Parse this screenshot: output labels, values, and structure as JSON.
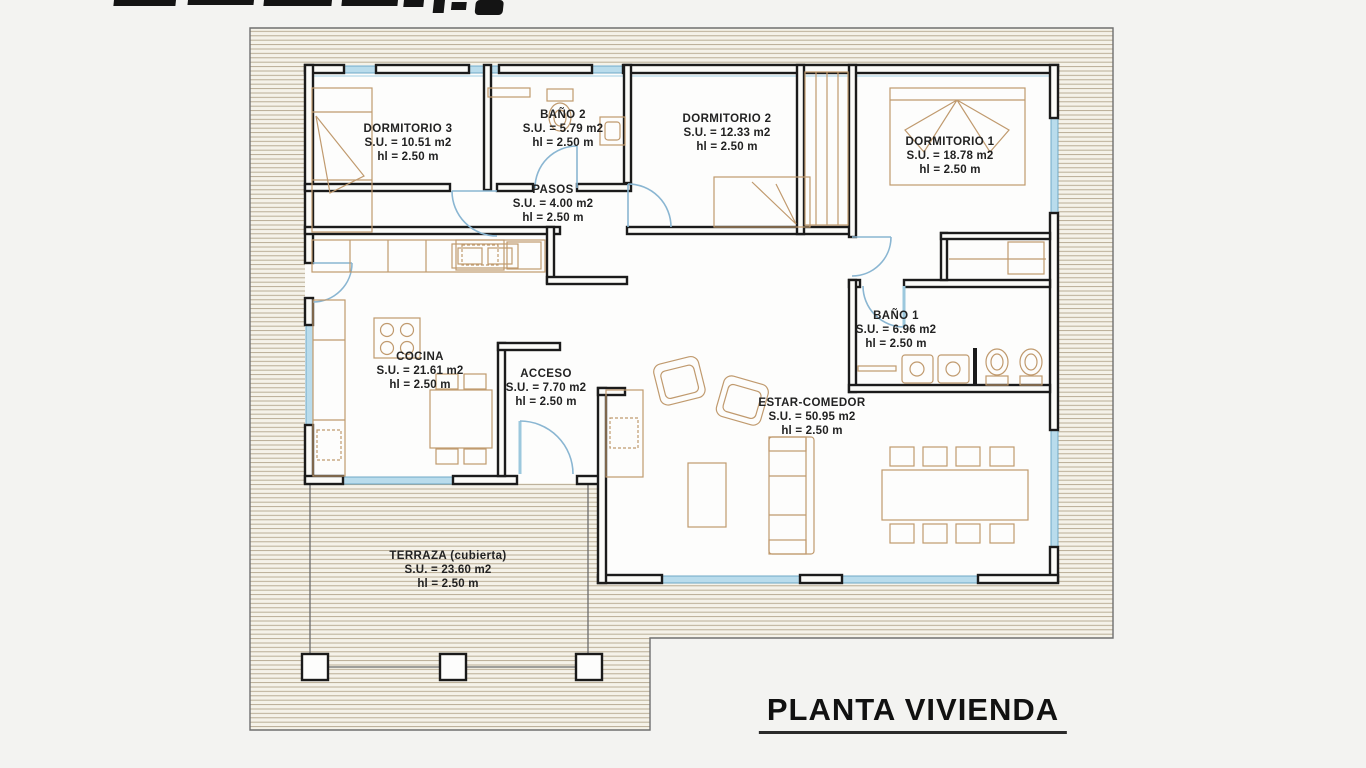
{
  "plan": {
    "title": "PLANTA VIVIENDA",
    "rooms": [
      {
        "id": "dormitorio-3",
        "name": "DORMITORIO 3",
        "su": "S.U. = 10.51 m2",
        "hl": "hl = 2.50 m"
      },
      {
        "id": "bano-2",
        "name": "BAÑO 2",
        "su": "S.U. = 5.79 m2",
        "hl": "hl = 2.50 m"
      },
      {
        "id": "dormitorio-2",
        "name": "DORMITORIO 2",
        "su": "S.U. = 12.33 m2",
        "hl": "hl = 2.50 m"
      },
      {
        "id": "dormitorio-1",
        "name": "DORMITORIO 1",
        "su": "S.U. = 18.78 m2",
        "hl": "hl = 2.50 m"
      },
      {
        "id": "pasos",
        "name": "PASOS",
        "su": "S.U. = 4.00 m2",
        "hl": "hl = 2.50 m"
      },
      {
        "id": "cocina",
        "name": "COCINA",
        "su": "S.U. = 21.61 m2",
        "hl": "hl = 2.50 m"
      },
      {
        "id": "acceso",
        "name": "ACCESO",
        "su": "S.U. = 7.70 m2",
        "hl": "hl = 2.50 m"
      },
      {
        "id": "bano-1",
        "name": "BAÑO 1",
        "su": "S.U. = 6.96 m2",
        "hl": "hl = 2.50 m"
      },
      {
        "id": "estar-comedor",
        "name": "ESTAR-COMEDOR",
        "su": "S.U. = 50.95 m2",
        "hl": "hl = 2.50 m"
      },
      {
        "id": "terraza",
        "name": "TERRAZA (cubierta)",
        "su": "S.U. = 23.60 m2",
        "hl": "hl = 2.50 m"
      }
    ]
  },
  "colors": {
    "wall": "#1b1b1b",
    "window_fill": "#b9dcec",
    "window_stroke": "#6fa9c6",
    "hatch_line": "#b3a68c",
    "hatch_bg": "#f5f2e9",
    "furniture": "#c09a6e",
    "door_arc": "#8ab6d2",
    "text": "#222222",
    "paper": "#f3f3f1",
    "floor": "#fdfdfc"
  }
}
